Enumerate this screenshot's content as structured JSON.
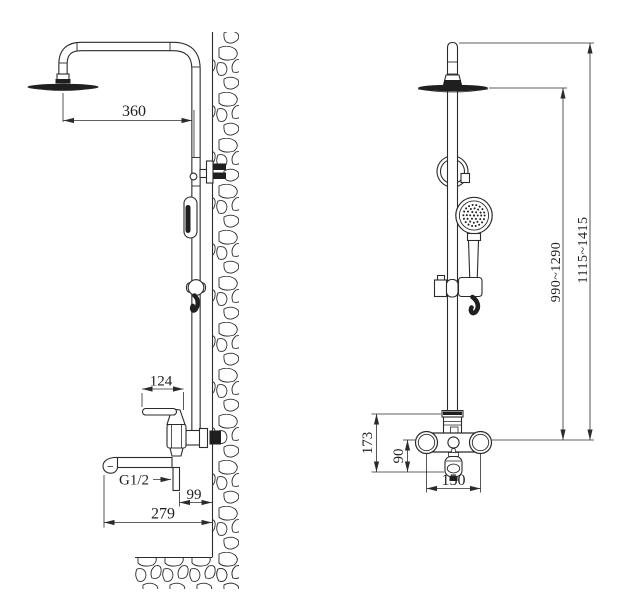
{
  "drawing": {
    "description": "Wall-mounted rain shower column installation drawing, side view and front view, dimensions in mm",
    "colors": {
      "line": "#2b2b2b",
      "dark_fill": "#1f1f1f",
      "background": "#ffffff"
    },
    "dimensions": {
      "side_view": {
        "head_to_column": "360",
        "handle_length": "124",
        "inlet_thread": "G1/2",
        "outlet_to_wall": "99",
        "spout_reach": "279"
      },
      "front_view": {
        "valve_to_spout_height": "173",
        "center_to_spout": "90",
        "inlet_centers": "150",
        "head_height_range": "990~1290",
        "overall_height_range": "1115~1415"
      }
    }
  }
}
